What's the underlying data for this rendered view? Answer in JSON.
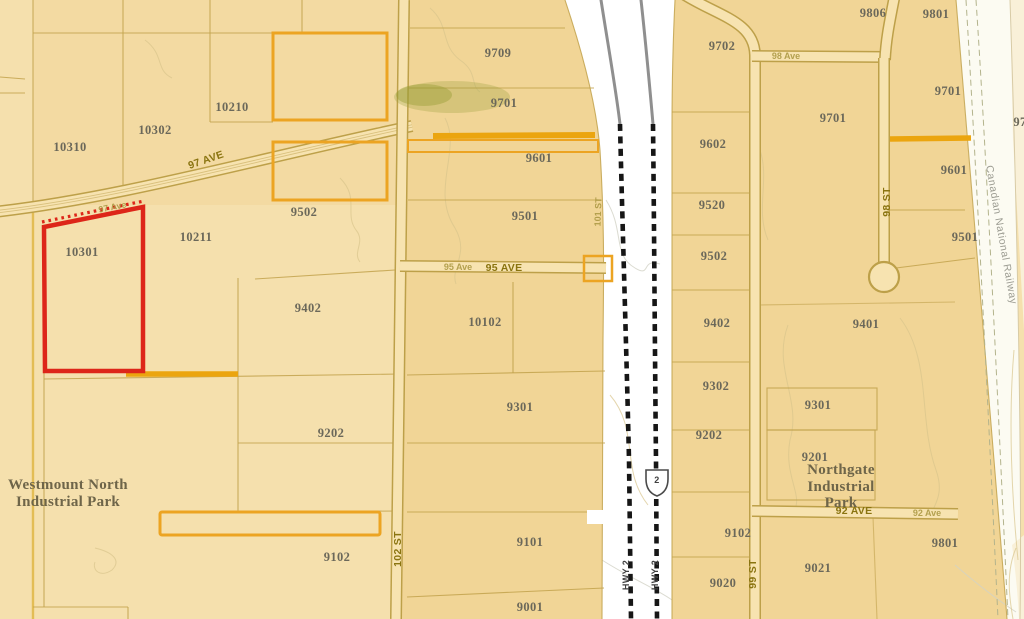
{
  "map": {
    "type": "cadastral-parcel-map",
    "colors": {
      "base_tan": "#f5e0ad",
      "subdivided_tan": "#f1d596",
      "road_fill": "#f7e3b0",
      "boundary_line": "#c2a24c",
      "highlight_orange": "#eca422",
      "selection_red": "#dd2619",
      "highway_corridor": "#ffffff",
      "railway_band": "#fcfbf2",
      "offmap_cream": "#f9f0d8"
    },
    "selection": {
      "parcel_id": "10301"
    },
    "parcels": [
      {
        "id": "10310"
      },
      {
        "id": "10302"
      },
      {
        "id": "10210"
      },
      {
        "id": "9502"
      },
      {
        "id": "10211"
      },
      {
        "id": "9402"
      },
      {
        "id": "9202"
      },
      {
        "id": "9102"
      },
      {
        "id": "9709"
      },
      {
        "id": "9701"
      },
      {
        "id": "9601"
      },
      {
        "id": "9501"
      },
      {
        "id": "10102"
      },
      {
        "id": "9301"
      },
      {
        "id": "9101"
      },
      {
        "id": "9001"
      },
      {
        "id": "9702"
      },
      {
        "id": "9602"
      },
      {
        "id": "9520"
      },
      {
        "id": "9502"
      },
      {
        "id": "9402"
      },
      {
        "id": "9302"
      },
      {
        "id": "9202"
      },
      {
        "id": "9102"
      },
      {
        "id": "9020"
      },
      {
        "id": "9806"
      },
      {
        "id": "9801"
      },
      {
        "id": "9701"
      },
      {
        "id": "9701"
      },
      {
        "id": "9601"
      },
      {
        "id": "9501"
      },
      {
        "id": "9401"
      },
      {
        "id": "9301"
      },
      {
        "id": "9201"
      },
      {
        "id": "9021"
      },
      {
        "id": "9801"
      },
      {
        "id": "97"
      }
    ],
    "streets": {
      "ave97_major": "97 AVE",
      "ave97_minor": "97 Ave",
      "ave95_major": "95 AVE",
      "ave95_minor": "95 Ave",
      "st102": "102 ST",
      "st101": "101 ST",
      "ave98": "98 Ave",
      "st98": "98 ST",
      "st99": "99 ST",
      "ave92_major": "92 AVE",
      "ave92_minor": "92 Ave",
      "hwy2": "HWY 2"
    },
    "highway_shield": {
      "number": "2"
    },
    "railway": {
      "label": "Canadian National Railway"
    },
    "parks": {
      "westmount_line1": "Westmount North",
      "westmount_line2": "Industrial Park",
      "northgate_line1": "Northgate",
      "northgate_line2": "Industrial",
      "northgate_line3": "Park"
    }
  }
}
